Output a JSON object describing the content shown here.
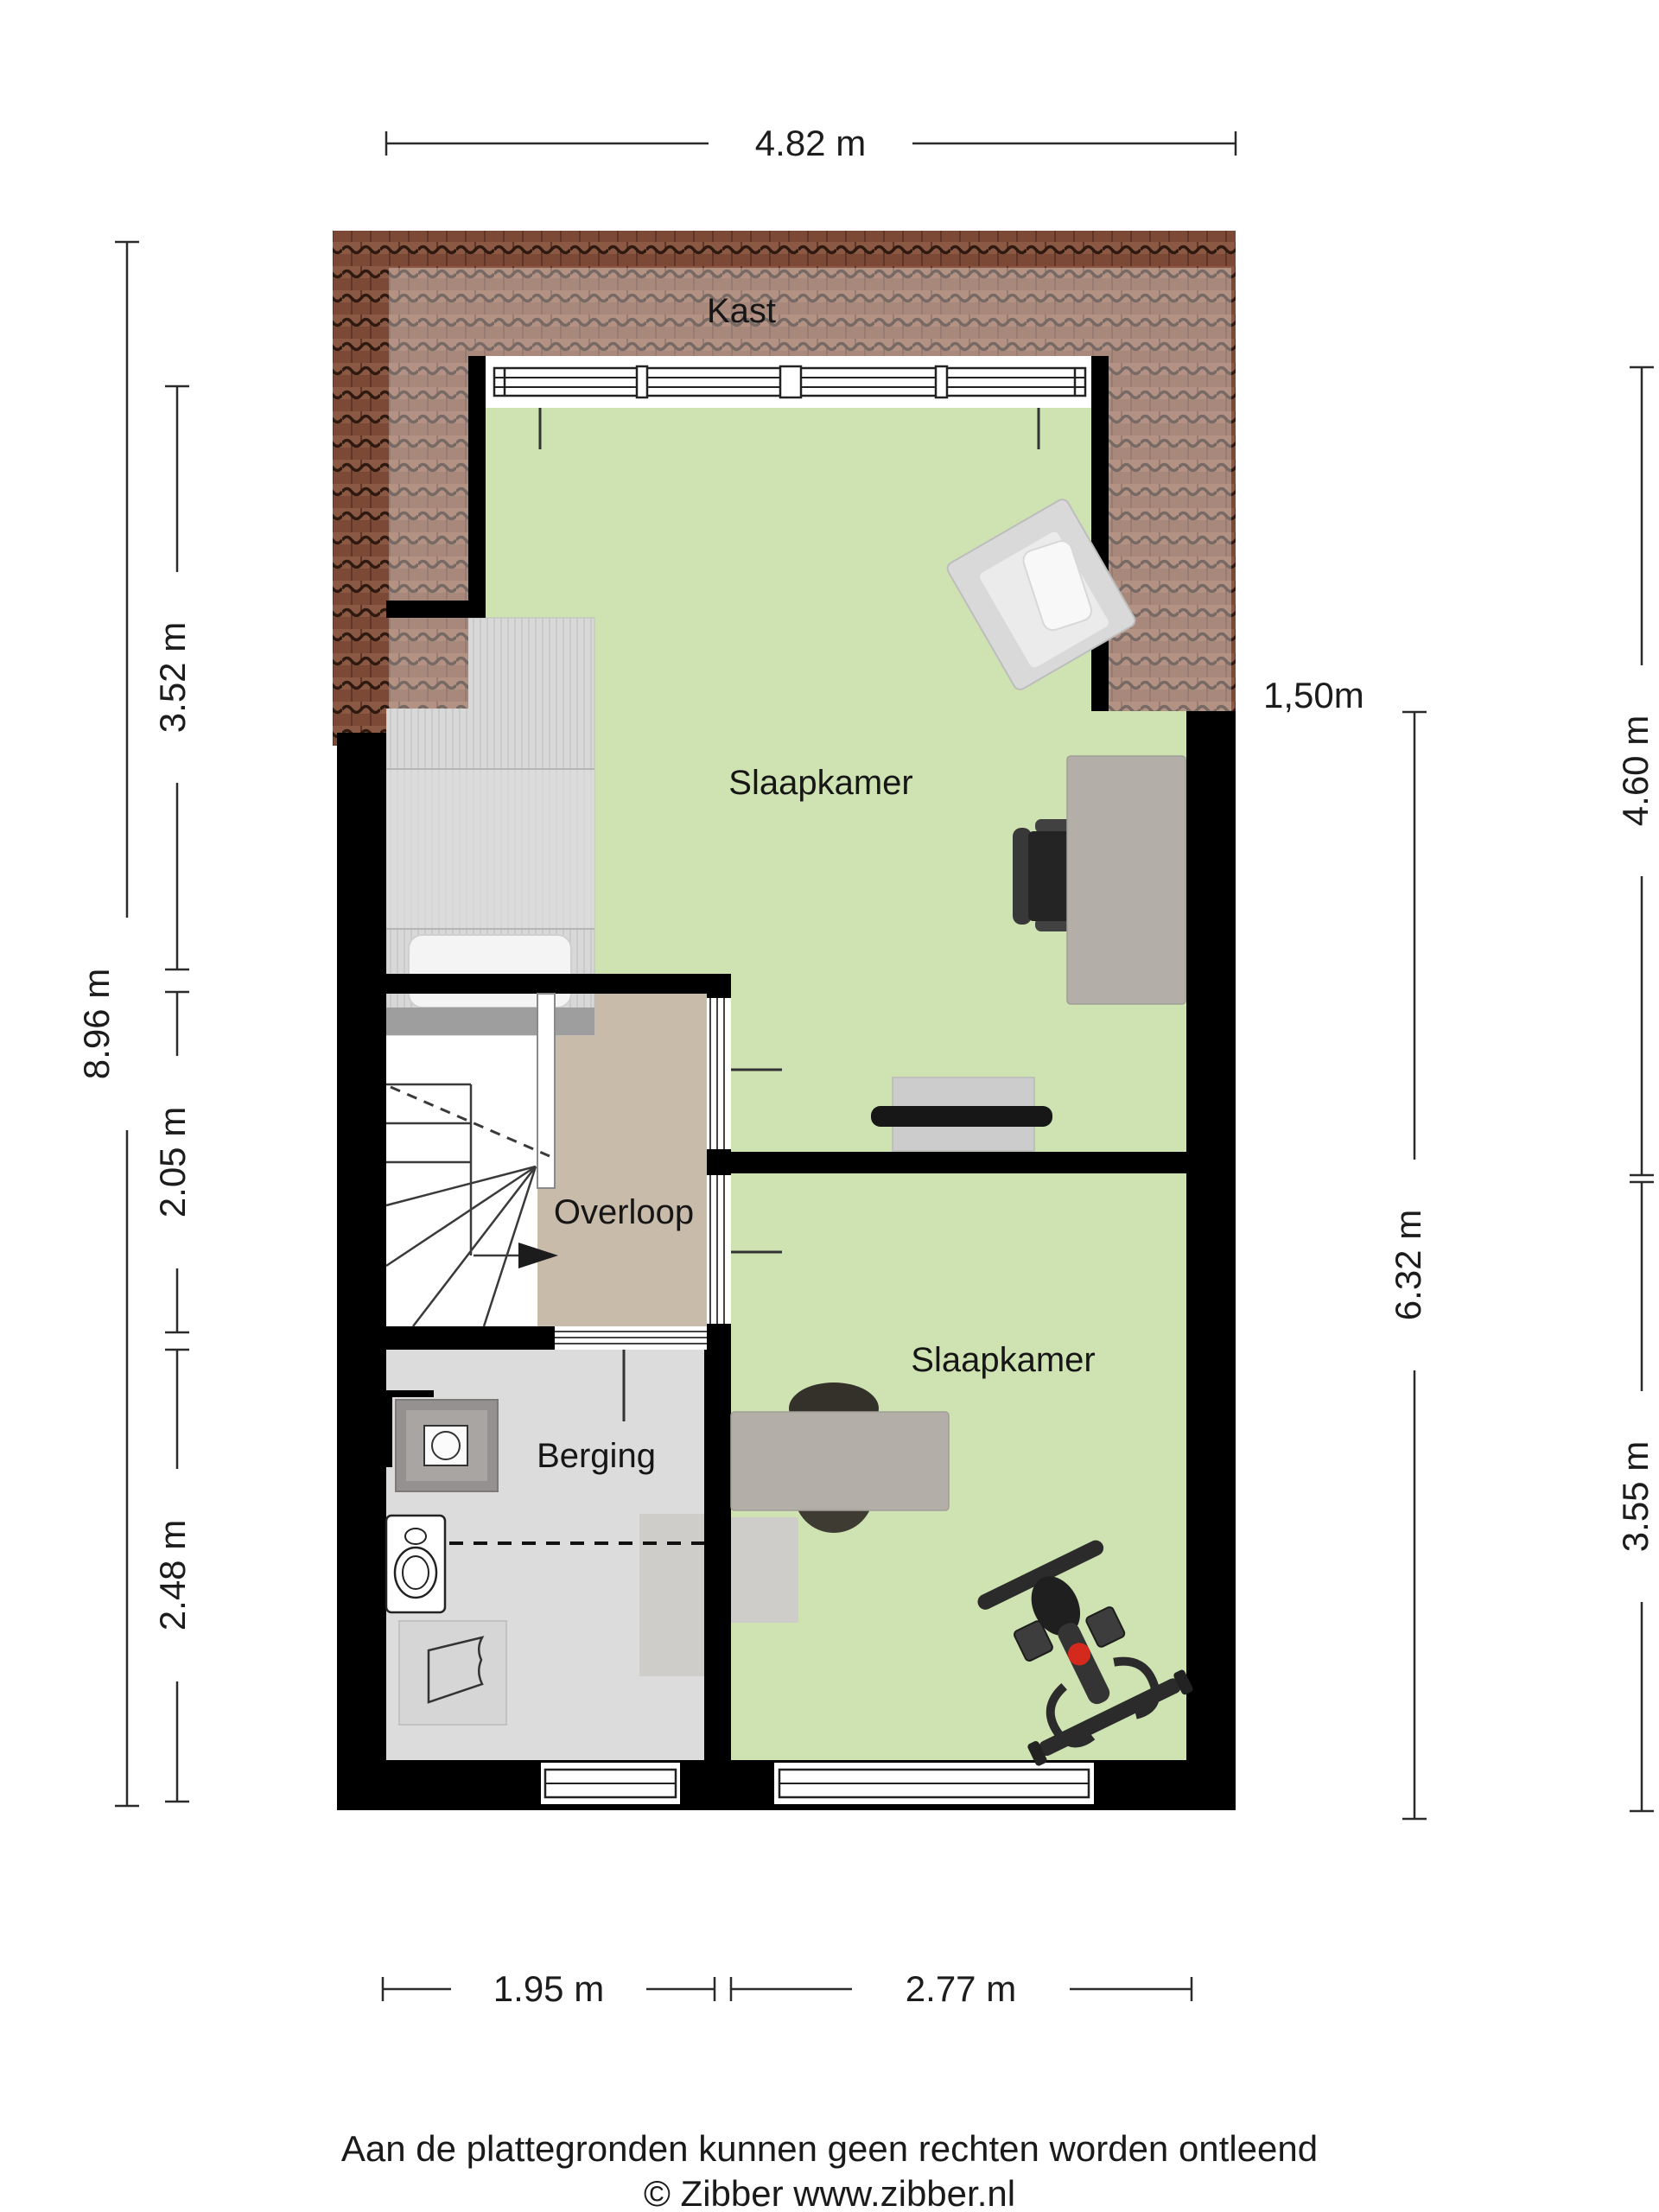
{
  "floorplan": {
    "rooms": {
      "kast": {
        "label": "Kast"
      },
      "slaapkamer_boven": {
        "label": "Slaapkamer"
      },
      "overloop": {
        "label": "Overloop"
      },
      "berging": {
        "label": "Berging"
      },
      "slaapkamer_onder": {
        "label": "Slaapkamer"
      }
    },
    "dimensions": {
      "top_width": "4.82 m",
      "left_total_height": "8.96 m",
      "left_seg_1": "3.52 m",
      "left_seg_2": "2.05 m",
      "left_seg_3": "2.48 m",
      "right_inner_height": "6.32 m",
      "right_seg_1": "4.60 m",
      "right_seg_2": "3.55 m",
      "bottom_seg_1": "1.95 m",
      "bottom_seg_2": "2.77 m",
      "headroom": "1,50m"
    },
    "footer": {
      "disclaimer": "Aan de plattegronden kunnen geen rechten worden ontleend",
      "credit": "© Zibber www.zibber.nl"
    },
    "colors": {
      "room_green": "#cfe3b2",
      "hall_tan": "#c9bbaa",
      "storage_grey": "#dcdcdc",
      "wall_black": "#000000",
      "roof_tile_brown": "#7b4936",
      "accent_red": "#d42a1e"
    }
  }
}
